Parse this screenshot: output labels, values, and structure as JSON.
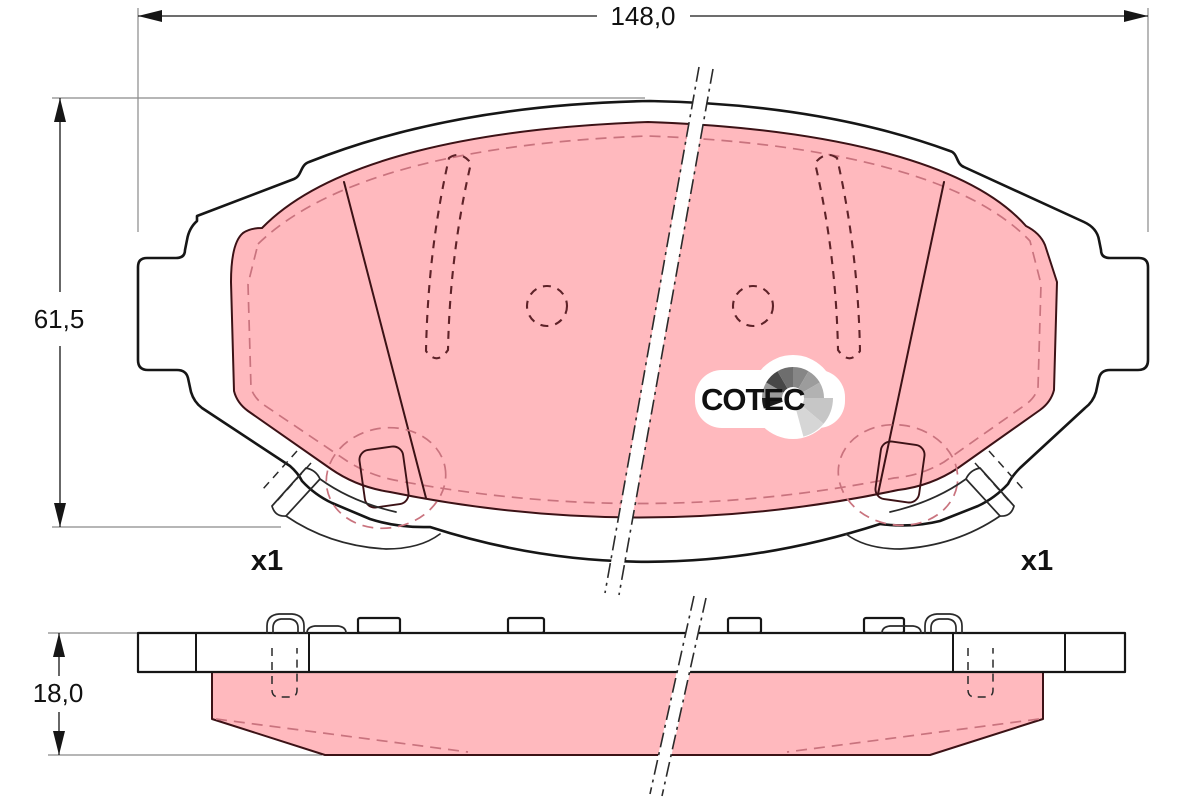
{
  "dimensions": {
    "overall_width": {
      "value": "148,0"
    },
    "overall_height": {
      "value": "61,5"
    },
    "pad_thickness": {
      "value": "18,0"
    }
  },
  "quantity_labels": {
    "left": "x1",
    "right": "x1"
  },
  "logo": {
    "brand": "COTEC"
  },
  "colors": {
    "pad_pink": "#ffb9be",
    "pink_edge": "#3c1216",
    "pink_dash": "#c9737e",
    "hole_dash": "#5d2228",
    "line": "#161616",
    "dim_gray": "#8a8a8a",
    "clip_line": "#2a2a2a",
    "logo_text": "#101010"
  }
}
